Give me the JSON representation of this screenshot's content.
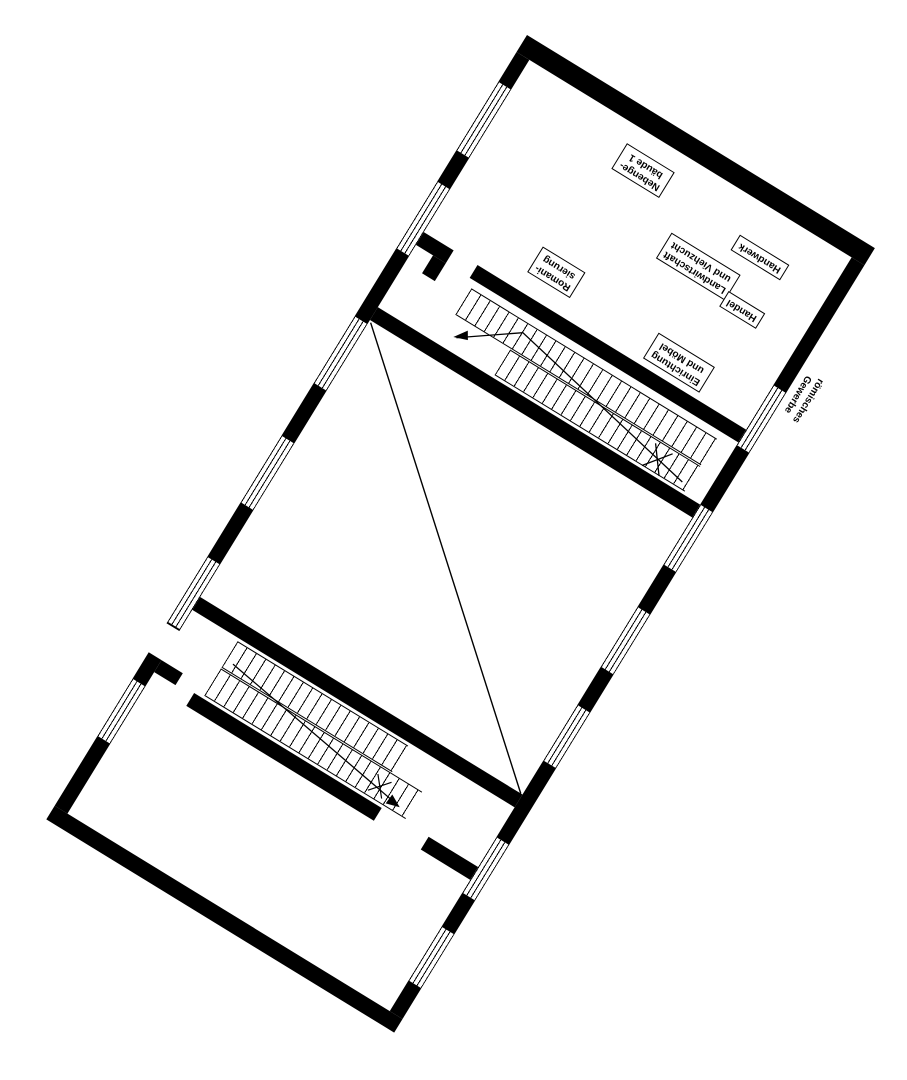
{
  "colors": {
    "ink": "#000000",
    "paper": "#ffffff"
  },
  "labels": {
    "nebengebaeude": [
      "Nebenge-",
      "bäude 1"
    ],
    "handwerk": [
      "Handwerk"
    ],
    "landwirtschaft": [
      "Landwirtschaft",
      "und Viehzucht"
    ],
    "handel": [
      "Handel"
    ],
    "romanisierung": [
      "Romani-",
      "sierung"
    ],
    "einrichtung": [
      "Einrichtung",
      "und Möbel"
    ],
    "roemisches_gewerbe": [
      "römisches",
      "Gewerbe"
    ]
  }
}
